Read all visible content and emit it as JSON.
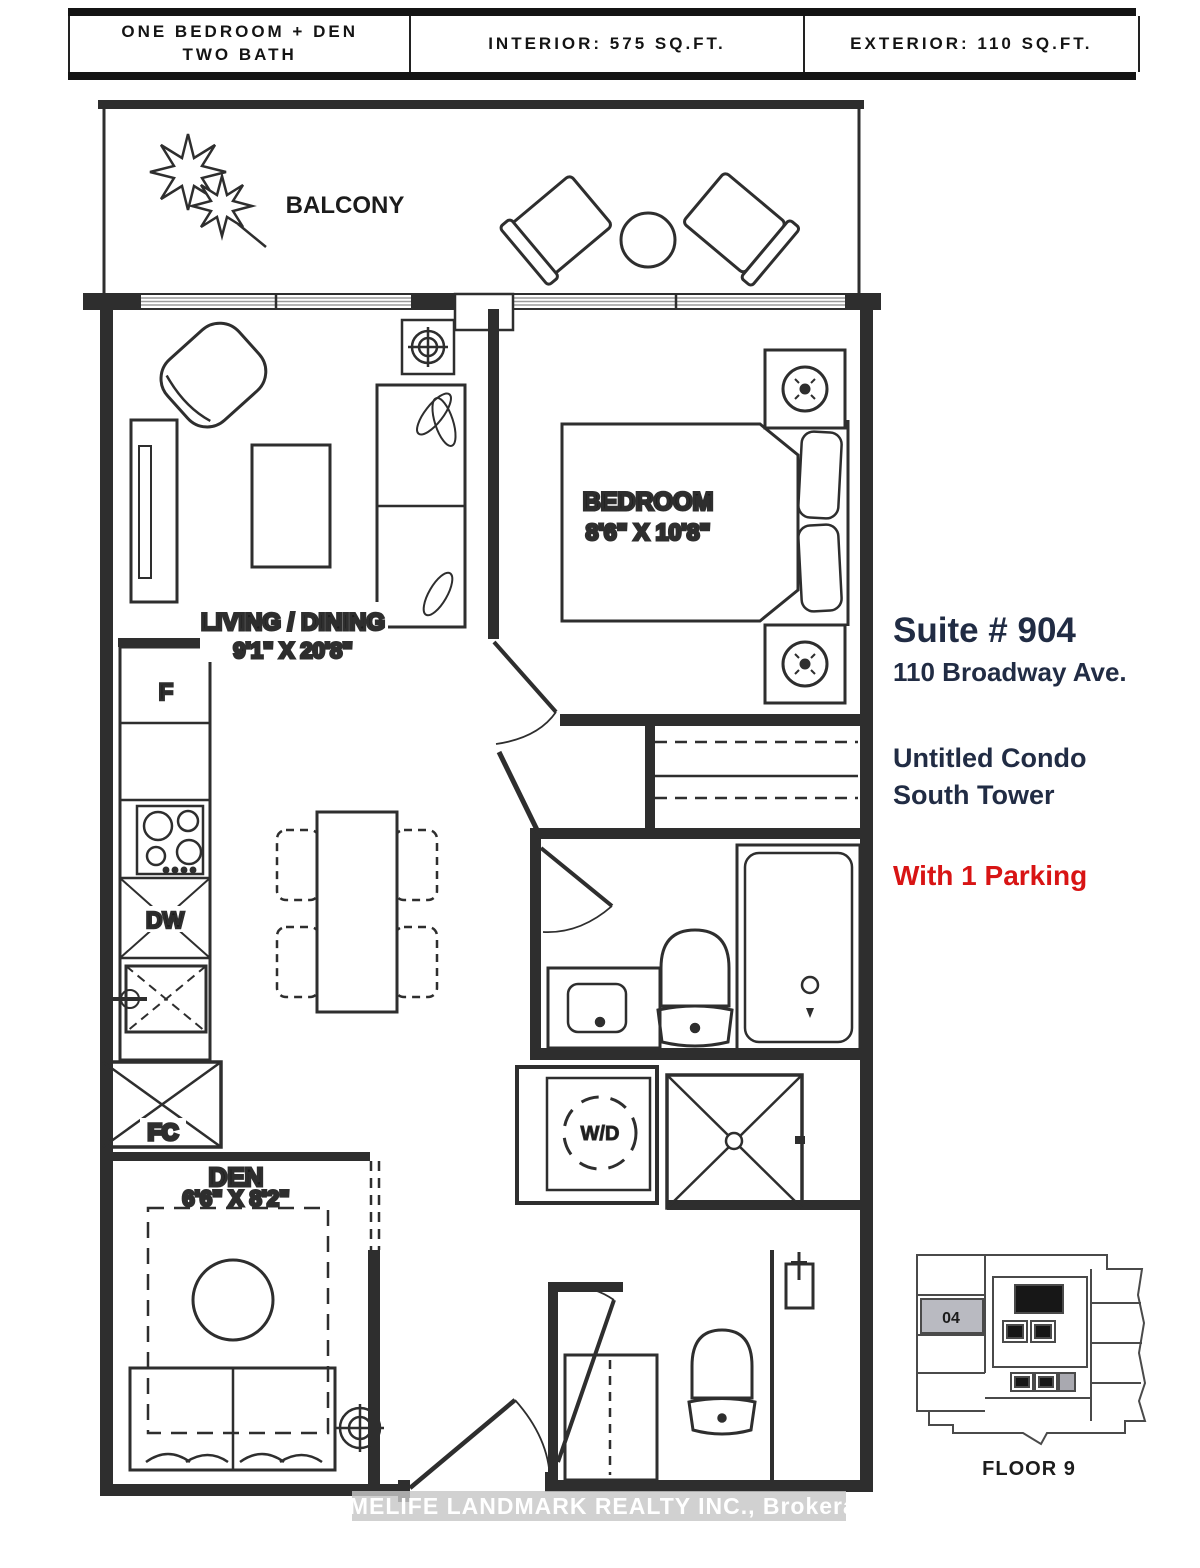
{
  "header": {
    "unit_type_line1": "ONE BEDROOM + DEN",
    "unit_type_line2": "TWO BATH",
    "interior": "INTERIOR: 575 SQ.FT.",
    "exterior": "EXTERIOR: 110 SQ.FT."
  },
  "plan": {
    "balcony_label": "BALCONY",
    "bedroom_label": "BEDROOM",
    "bedroom_dims": "8'6\" X 10'8\"",
    "living_label": "LIVING / DINING",
    "living_dims": "9'1\" X 20'8\"",
    "den_label": "DEN",
    "den_dims": "6'6\" X 8'2\"",
    "fridge_label": "F",
    "dishwasher_label": "DW",
    "fan_coil_label": "FC",
    "washer_dryer_label": "W/D"
  },
  "info": {
    "suite": "Suite # 904",
    "address": "110 Broadway Ave.",
    "building_line1": "Untitled Condo",
    "building_line2": "South Tower",
    "parking": "With 1 Parking"
  },
  "keyplan": {
    "unit_label": "04",
    "floor_label": "FLOOR 9"
  },
  "watermark": "HOMELIFE LANDMARK REALTY INC., Brokerage",
  "icons": {
    "plant": "maple-leaf-cluster",
    "ceiling-light": "circle-crosshair",
    "shower": "square-x-with-drain",
    "kitchen-sink": "square-x-with-faucet",
    "fan-coil-closet": "square-x"
  },
  "colors": {
    "accent_red": "#d81414",
    "text_navy": "#212c44",
    "plan_line": "#2e2e2e",
    "keyplan_unit_fill": "#b9bac1"
  }
}
